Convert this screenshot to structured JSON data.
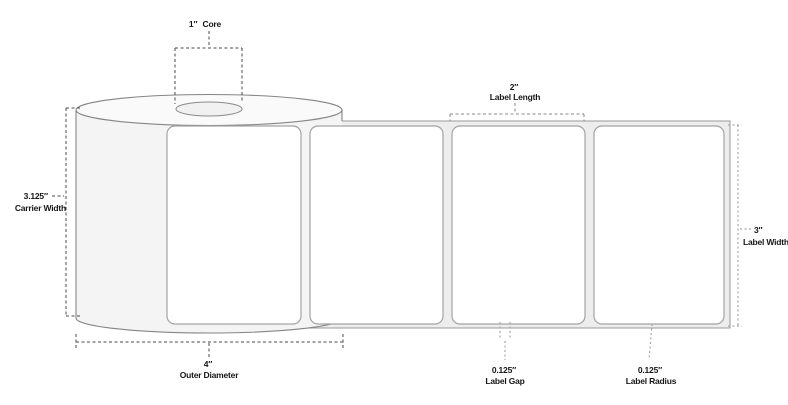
{
  "diagram": {
    "subject": "label-roll-dimensions",
    "annotations": {
      "core": {
        "value": "1″",
        "label": "Core"
      },
      "label_length": {
        "value": "2″",
        "label": "Label Length"
      },
      "carrier_width": {
        "value": "3.125″",
        "label": "Carrier Width"
      },
      "label_width": {
        "value": "3″",
        "label": "Label Width"
      },
      "outer_diameter": {
        "value": "4″",
        "label": "Outer Diameter"
      },
      "label_gap": {
        "value": "0.125″",
        "label": "Label Gap"
      },
      "label_radius": {
        "value": "0.125″",
        "label": "Label Radius"
      }
    },
    "colors": {
      "background": "#ffffff",
      "outline": "#858585",
      "label_stroke": "#a3a3a3",
      "label_fill": "#ffffff",
      "liner_fill": "#ededed",
      "roll_fill": "#f4f4f4",
      "roll_top_fill": "#fafafa",
      "core_fill": "#f1f1f1",
      "dark_dash": "#4a4a4a",
      "light_dash": "#a8a8a8",
      "text": "#161616"
    }
  }
}
